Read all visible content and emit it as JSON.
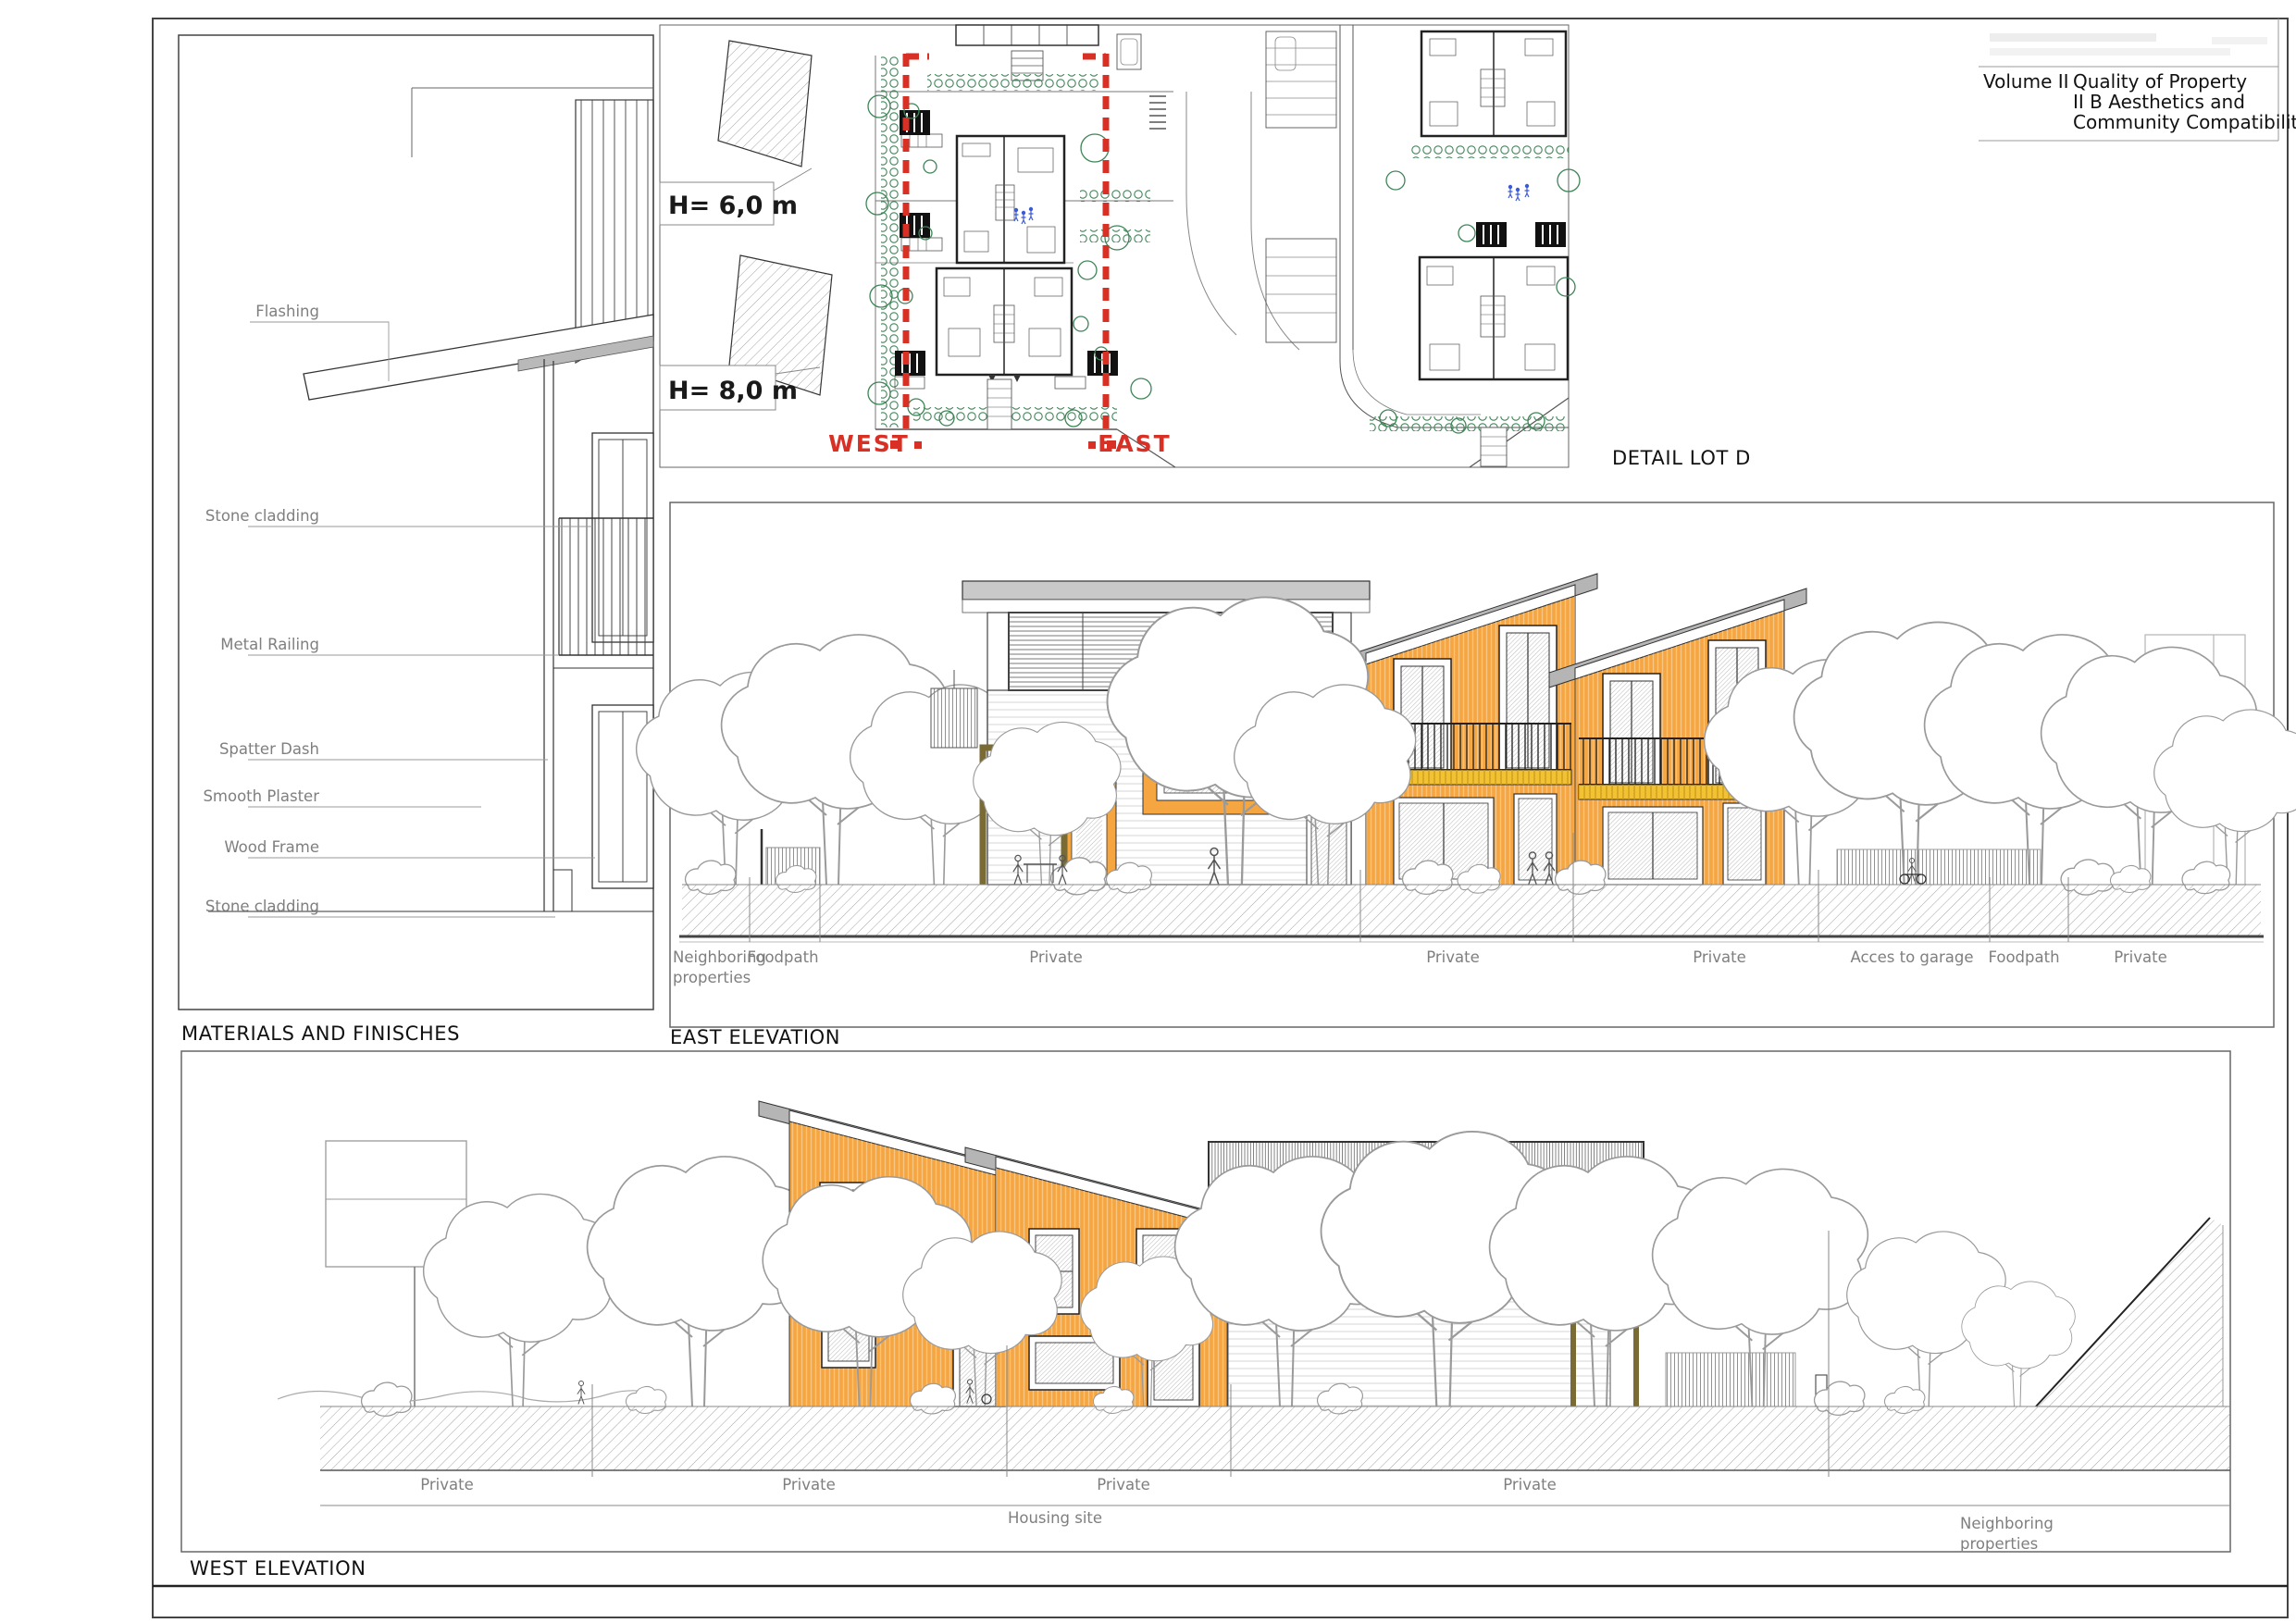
{
  "colors": {
    "orange": "#F6A640",
    "yellow_band": "#F1C232",
    "roof_gray": "#B5B5B5",
    "cap_gray": "#C9C9C9",
    "section_red": "#D83025",
    "label_gray": "#7F7F7F",
    "hedge_green": "#3D8456",
    "figure_blue": "#3B5BD6",
    "pergola_brown": "#7A6A33"
  },
  "title_block": {
    "volume": "Volume II",
    "line1": "Quality of Property",
    "line2": "II B  Aesthetics and",
    "line3": "Community Compatibility"
  },
  "materials": {
    "title": "MATERIALS AND FINISCHES",
    "labels": [
      "Flashing",
      "Stone cladding",
      "Metal Railing",
      "Spatter Dash",
      "Smooth Plaster",
      "Wood Frame",
      "Stone cladding"
    ]
  },
  "site": {
    "title": "DETAIL LOT D",
    "h1": "H= 6,0 m",
    "h2": "H= 8,0 m",
    "west": "WEST",
    "east": "EAST"
  },
  "east": {
    "title": "EAST ELEVATION",
    "neighboring": [
      "Neighboring",
      "properties"
    ],
    "labels": [
      "Foodpath",
      "Private",
      "Private",
      "Private",
      "Acces to garage",
      "Foodpath",
      "Private"
    ]
  },
  "west": {
    "title": "WEST ELEVATION",
    "labels": [
      "Private",
      "Private",
      "Private",
      "Private"
    ],
    "housing": "Housing site",
    "neighboring": [
      "Neighboring",
      "properties"
    ]
  }
}
